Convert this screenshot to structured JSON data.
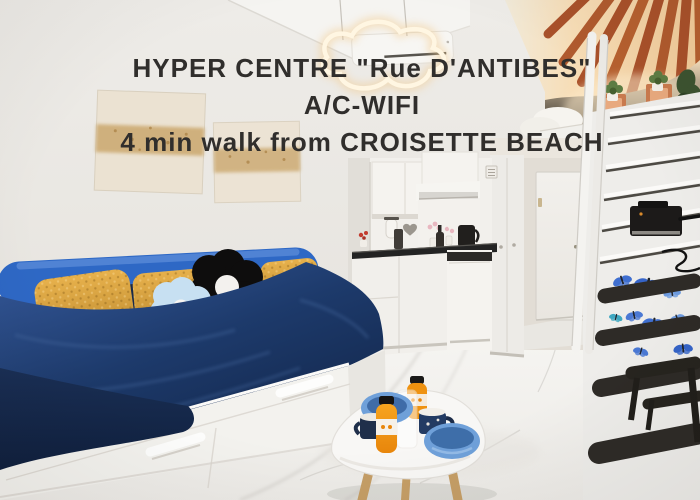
{
  "overlay": {
    "line1": "HYPER CENTRE \"Rue D'ANTIBES\"",
    "line2": "A/C-WIFI",
    "line3": "4 min walk from CROISETTE BEACH",
    "text_color": "#302e2c"
  },
  "scene": {
    "type": "studio-apartment-listing-photo",
    "colors": {
      "wall": "#e9e6e2",
      "ceiling": "#f5f4f1",
      "floor": "#f3f1ee",
      "marble_vein": "#c9c6c1",
      "daybed_blue": "#2e68c5",
      "bedding_navy": "#1c3a68",
      "pillow_yellow": "#daa33c",
      "flower_pillow_blue": "#c7e0f2",
      "flower_pillow_black": "#0e0d0d",
      "beam_terracotta": "#a9512a",
      "mezzanine_glow": "#f5d4a6",
      "stair_tread": "#2e2b27",
      "butterfly_blue": "#3f6fd0",
      "bowl_blue": "#6fa0d9",
      "juice_orange": "#ef9210",
      "table_leg_wood": "#c59e66",
      "text_color": "#302e2c"
    }
  }
}
